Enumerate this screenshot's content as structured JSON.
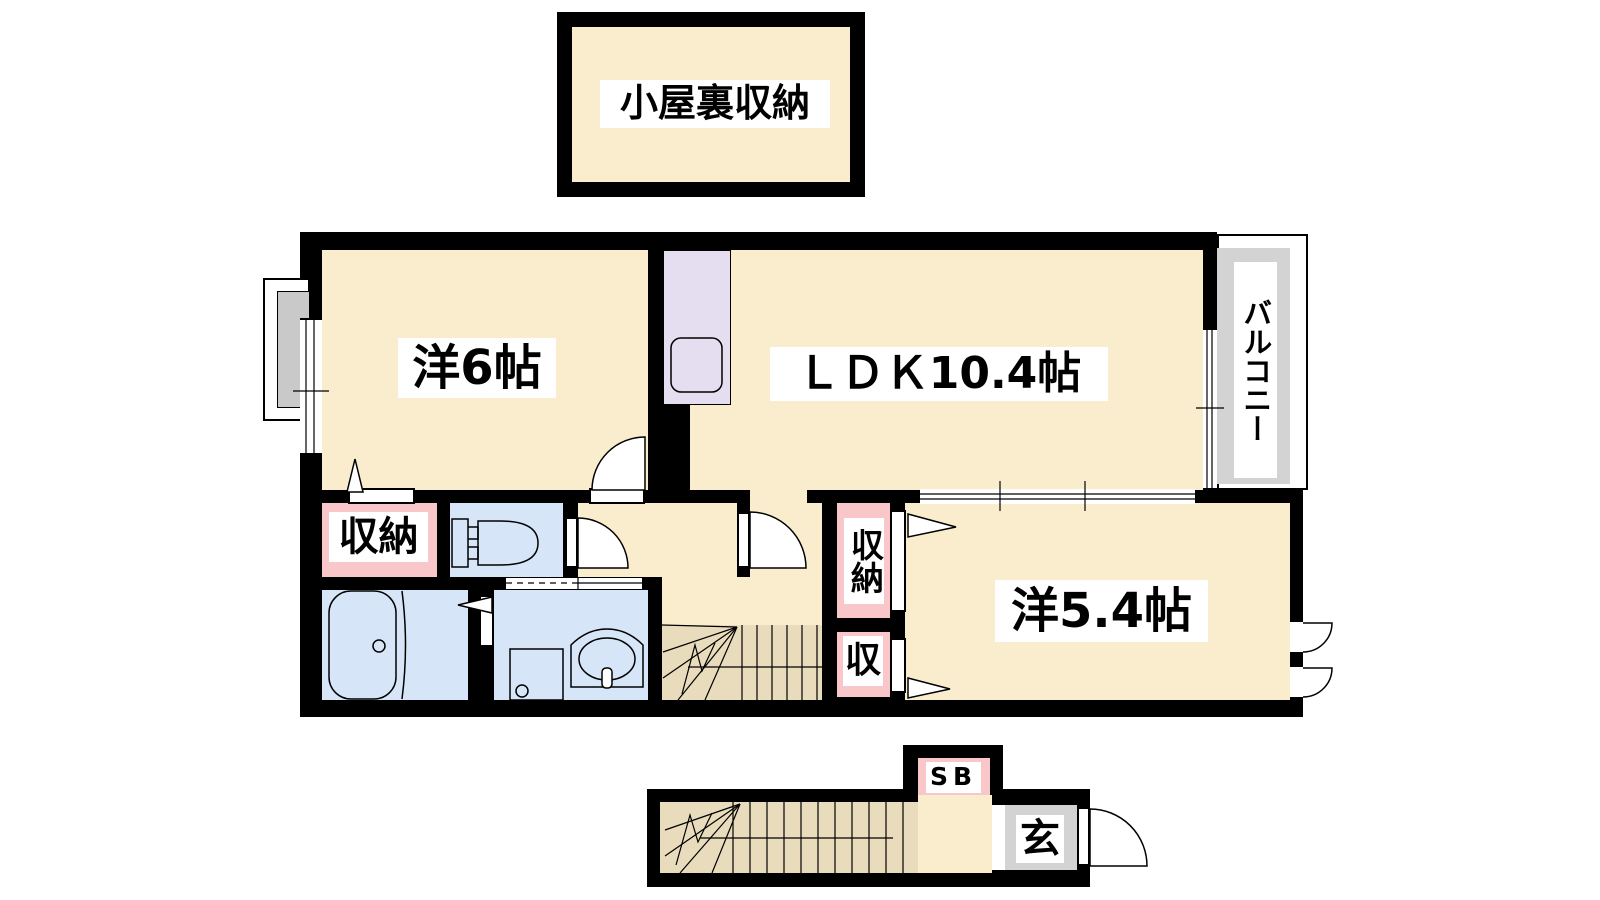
{
  "title": "2LDK apartment floor plan",
  "labels": {
    "attic": "小屋裏収納",
    "western_6": "洋6帖",
    "ldk": "ＬＤＫ10.4帖",
    "balcony": "バルコニー",
    "storage_west": "収納",
    "closet_upper": "収納",
    "closet_lower": "収",
    "western_5_4": "洋5.4帖",
    "shoe_box": "SB",
    "entrance": "玄"
  },
  "colors": {
    "wall": "#000000",
    "room_cream": "#FAEDCD",
    "stairs_tan": "#E9DCBC",
    "closet_pink": "#F9C7C9",
    "water_blue": "#D7E5F8",
    "kitchen_lavender": "#E5DDF0",
    "balcony_gray": "#D3D3D3",
    "entrance_gray": "#D3D3D3",
    "label_bg": "#FFFFFF"
  }
}
